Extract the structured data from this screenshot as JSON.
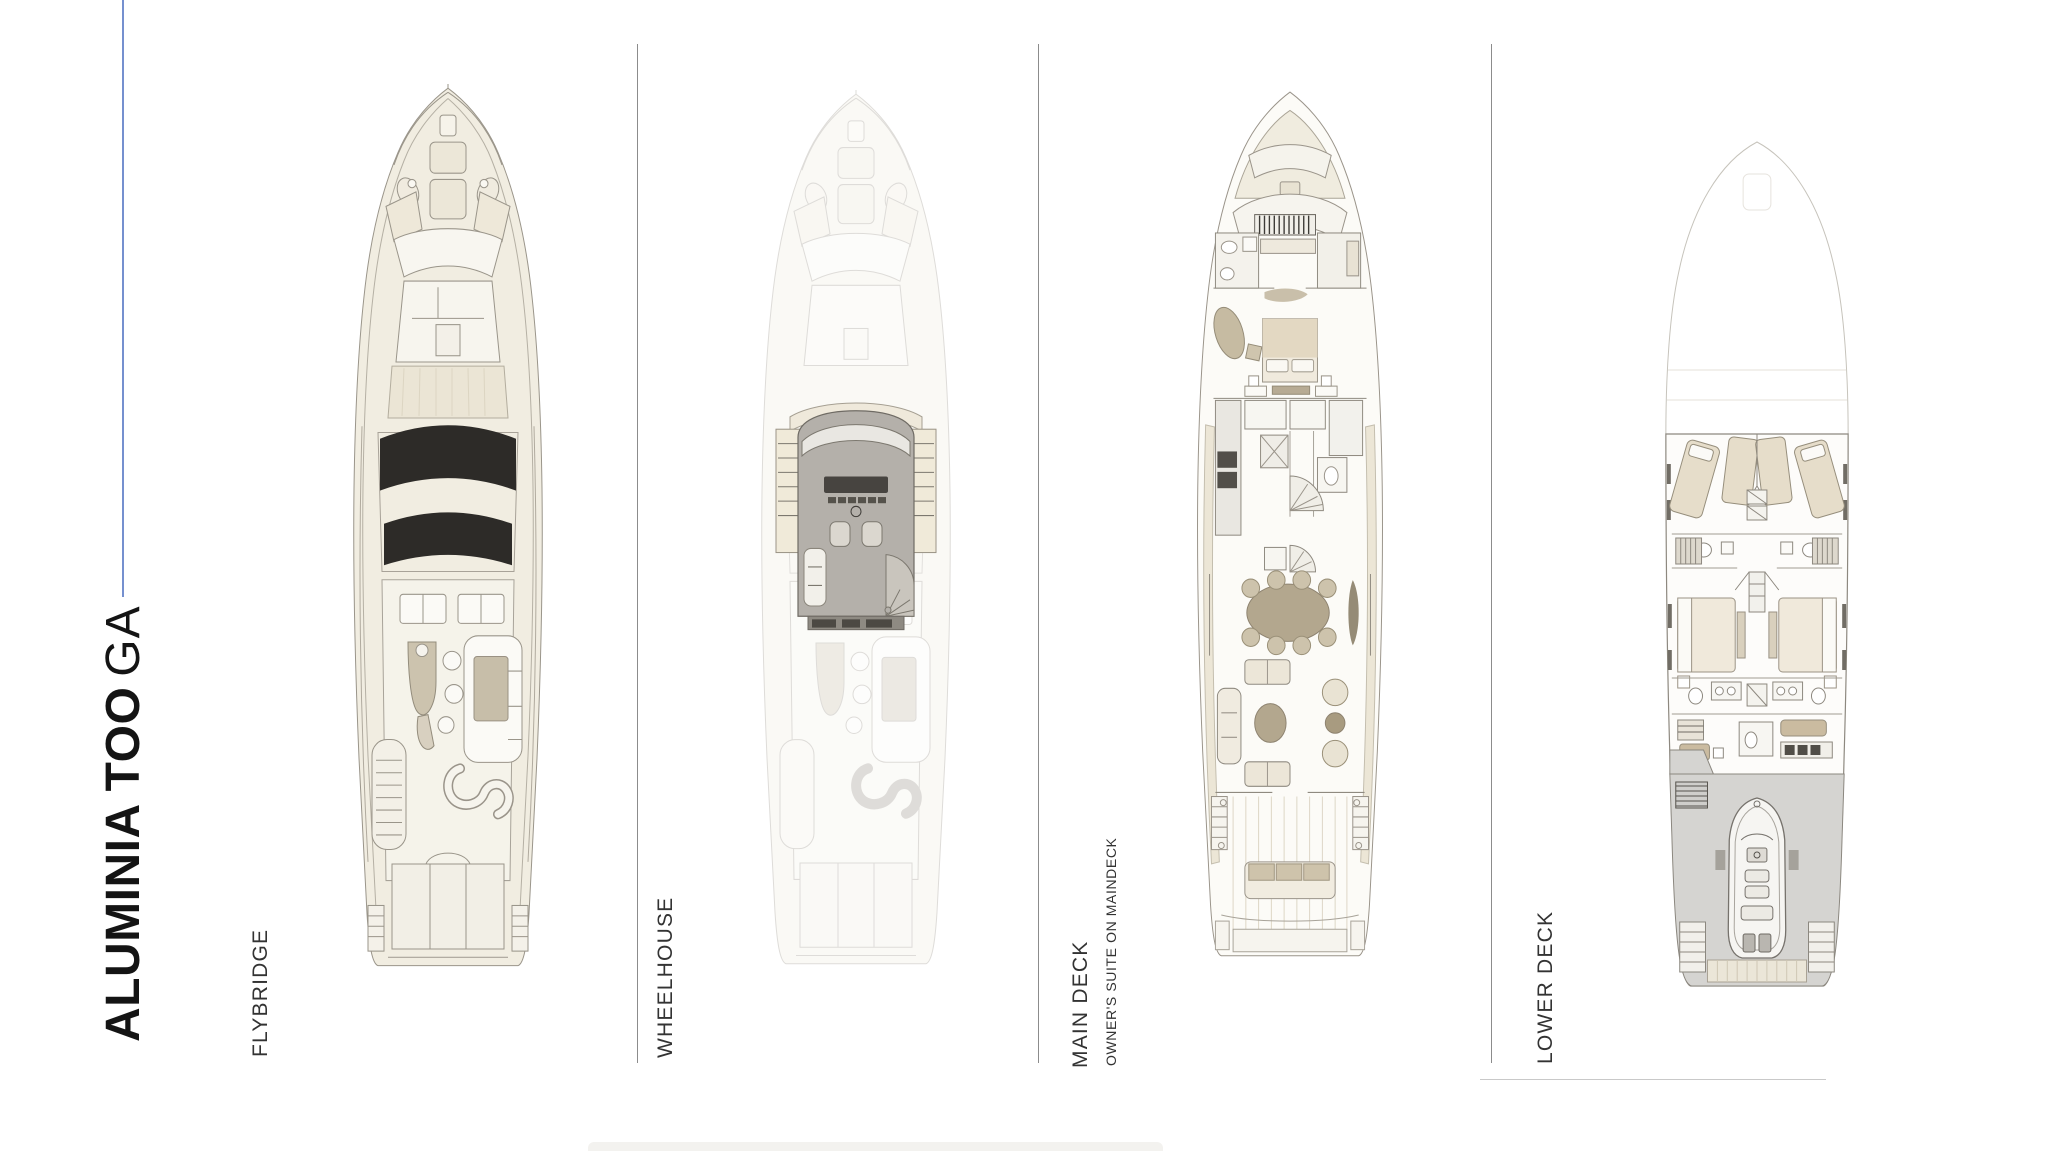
{
  "title": {
    "bold": "ALUMINIA TOO",
    "light": "GA"
  },
  "decks": [
    {
      "id": "flybridge",
      "label": "FLYBRIDGE",
      "sublabel": ""
    },
    {
      "id": "wheelhouse",
      "label": "WHEELHOUSE",
      "sublabel": ""
    },
    {
      "id": "main-deck",
      "label": "MAIN DECK",
      "sublabel": "OWNER'S SUITE ON MAINDECK"
    },
    {
      "id": "lower-deck",
      "label": "LOWER DECK",
      "sublabel": ""
    }
  ],
  "colors": {
    "accent_blue": "#7590cf",
    "section_divider": "#8c8c8c",
    "bottom_hairline": "#c9c9c9",
    "hull_cream": "#f1ede1",
    "furniture_tan": "#c7bea9",
    "sunroof_black": "#2d2b28",
    "wheelhouse_gray": "#b4b0aa",
    "garage_gray": "#d5d4d1"
  }
}
